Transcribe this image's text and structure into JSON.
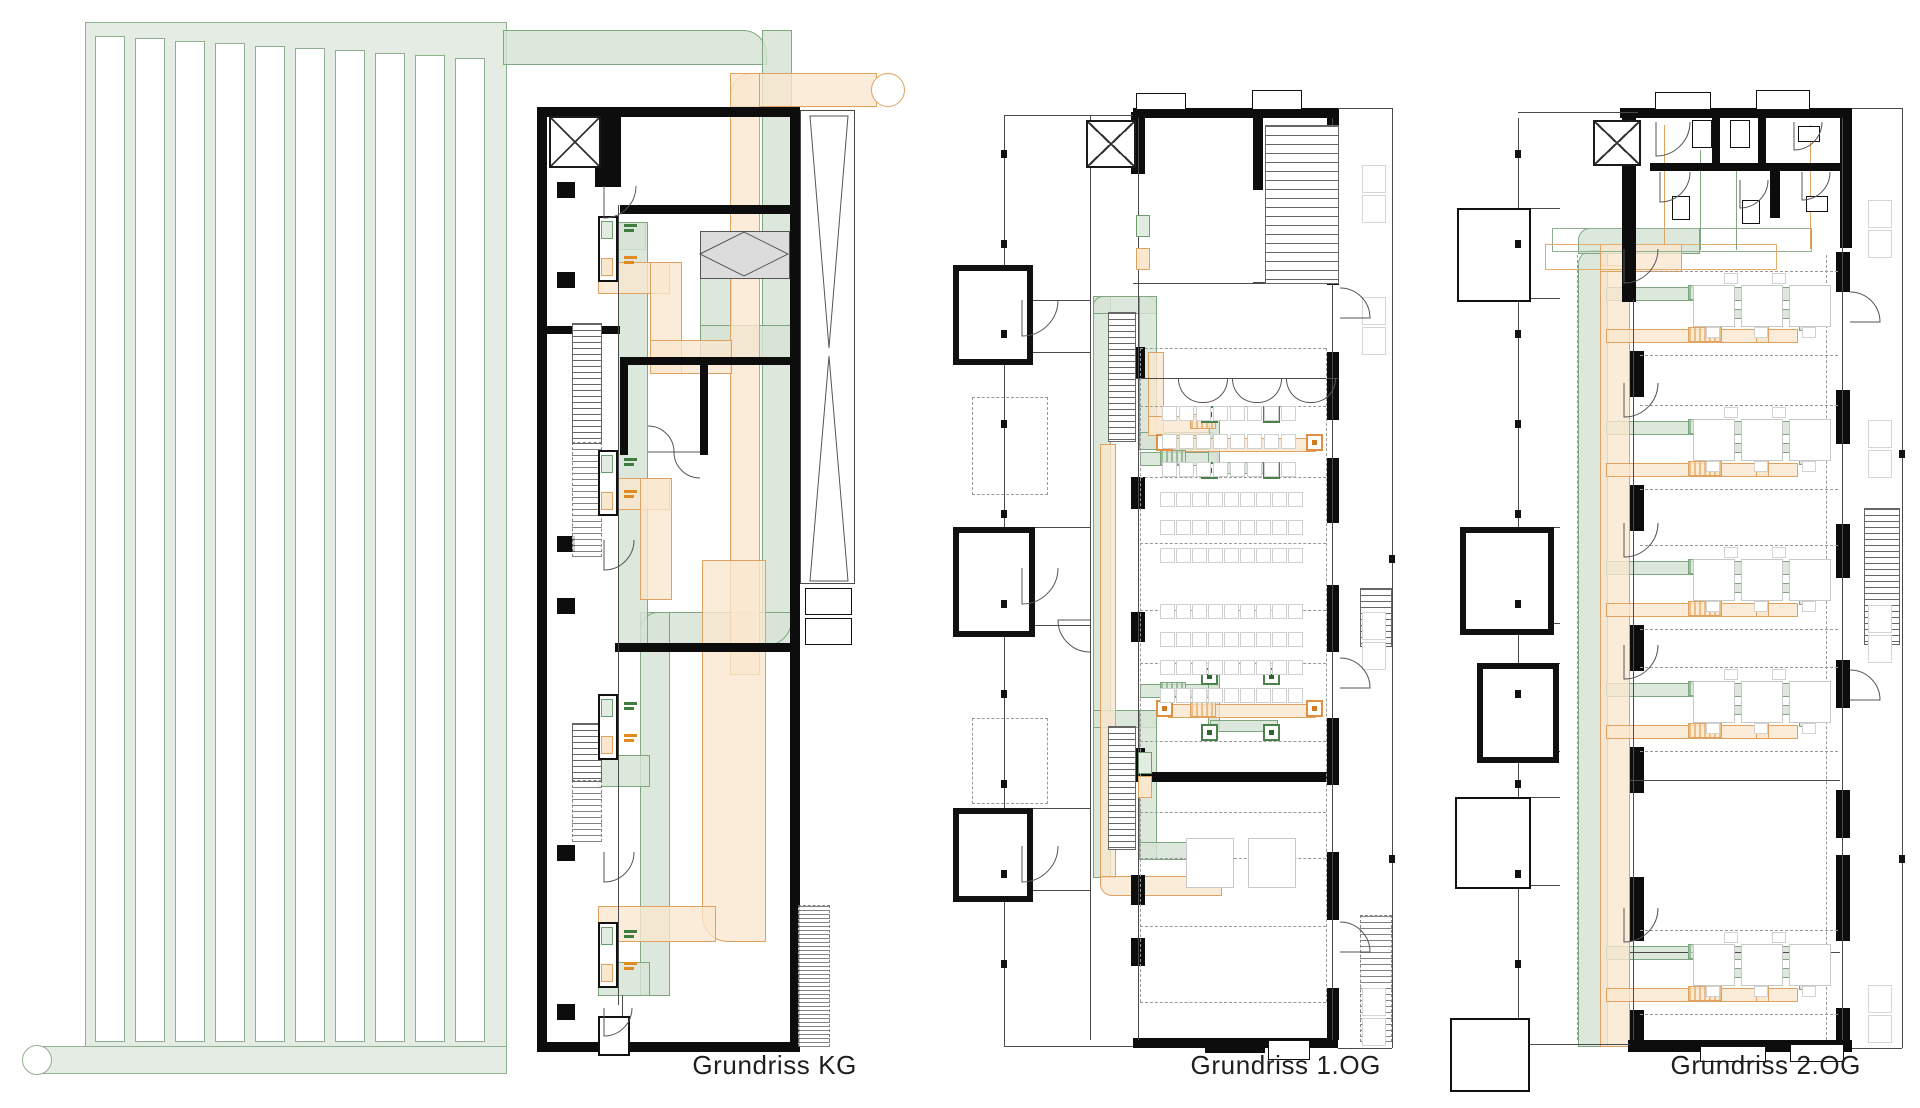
{
  "captions": {
    "kg": "Grundriss KG",
    "og1": "Grundriss 1.OG",
    "og2": "Grundriss 2.OG"
  },
  "colors": {
    "background": "#ffffff",
    "supply_air_green_fill": "#e3ece2",
    "supply_air_green_line": "#7fa77f",
    "extract_air_orange_fill": "#fbe7cd",
    "extract_air_orange_line": "#dfa260",
    "wall_black": "#0d0d0d",
    "equipment_grey_fill": "#dcdcdc",
    "furniture_grey_line": "#cfcfcf",
    "caption_text": "#1f1f1f"
  },
  "symbols": {
    "elevator": "shaft-with-x-icon",
    "supply_diffuser": "green-square-diffuser-icon",
    "extract_diffuser": "orange-square-diffuser-icon",
    "ground_collector": "serpentine-duct-field",
    "air_intake": "round-end-cap",
    "air_exhaust": "round-end-cap",
    "heat_exchanger": "grey-box-with-diamond"
  }
}
